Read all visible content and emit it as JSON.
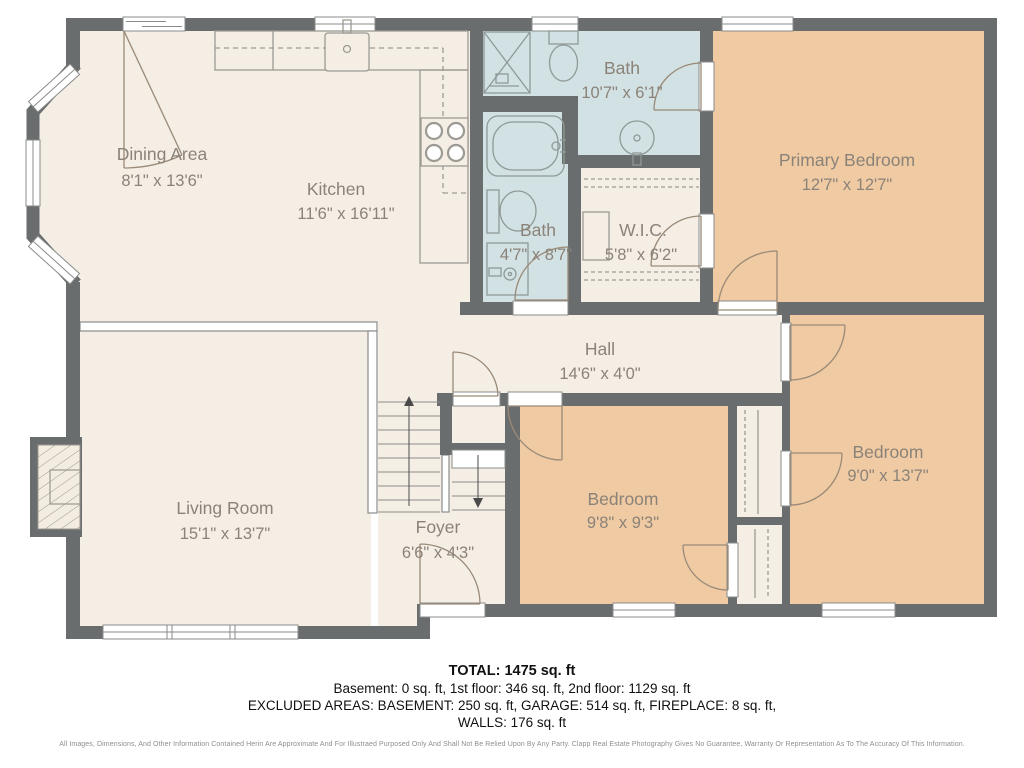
{
  "title": "Second floor plan",
  "colors": {
    "wall": "#6a6d6e",
    "floor_cream": "#f5eee5",
    "bedroom_tan": "#efcaa2",
    "bath_blue": "#d2e1e3",
    "label_gray": "#8b8379",
    "door_stroke": "#9a8a78",
    "fixture_stroke": "#8f9a97"
  },
  "rooms": [
    {
      "name": "Dining Area",
      "dims": "8'1\" x 13'6\""
    },
    {
      "name": "Kitchen",
      "dims": "11'6\" x 16'11\""
    },
    {
      "name": "Bath",
      "dims": "10'7\" x 6'1\""
    },
    {
      "name": "Primary Bedroom",
      "dims": "12'7\" x 12'7\""
    },
    {
      "name": "Bath",
      "dims": "4'7\" x 8'7\""
    },
    {
      "name": "W.I.C.",
      "dims": "5'8\" x 6'2\""
    },
    {
      "name": "Hall",
      "dims": "14'6\" x 4'0\""
    },
    {
      "name": "Living Room",
      "dims": "15'1\" x 13'7\""
    },
    {
      "name": "Foyer",
      "dims": "6'6\" x 4'3\""
    },
    {
      "name": "Bedroom",
      "dims": "9'8\" x 9'3\""
    },
    {
      "name": "Bedroom",
      "dims": "9'0\" x 13'7\""
    }
  ],
  "summary": {
    "total": "TOTAL: 1475 sq. ft",
    "floors": "Basement: 0 sq. ft, 1st floor: 346 sq. ft, 2nd floor: 1129 sq. ft",
    "excluded": "EXCLUDED AREAS: BASEMENT: 250 sq. ft, GARAGE: 514 sq. ft, FIREPLACE: 8 sq. ft,",
    "walls": "WALLS: 176 sq. ft",
    "disclaimer": "All Images, Dimensions, And Other Information Contained Herin Are Approximate And For Illustraed Purposed Only And Shall Not Be Relied Upon By Any Party. Clapp Real Estate Photography Gives No Guarantee, Warranty Or Representation As To The Accuracy Of This Information."
  }
}
